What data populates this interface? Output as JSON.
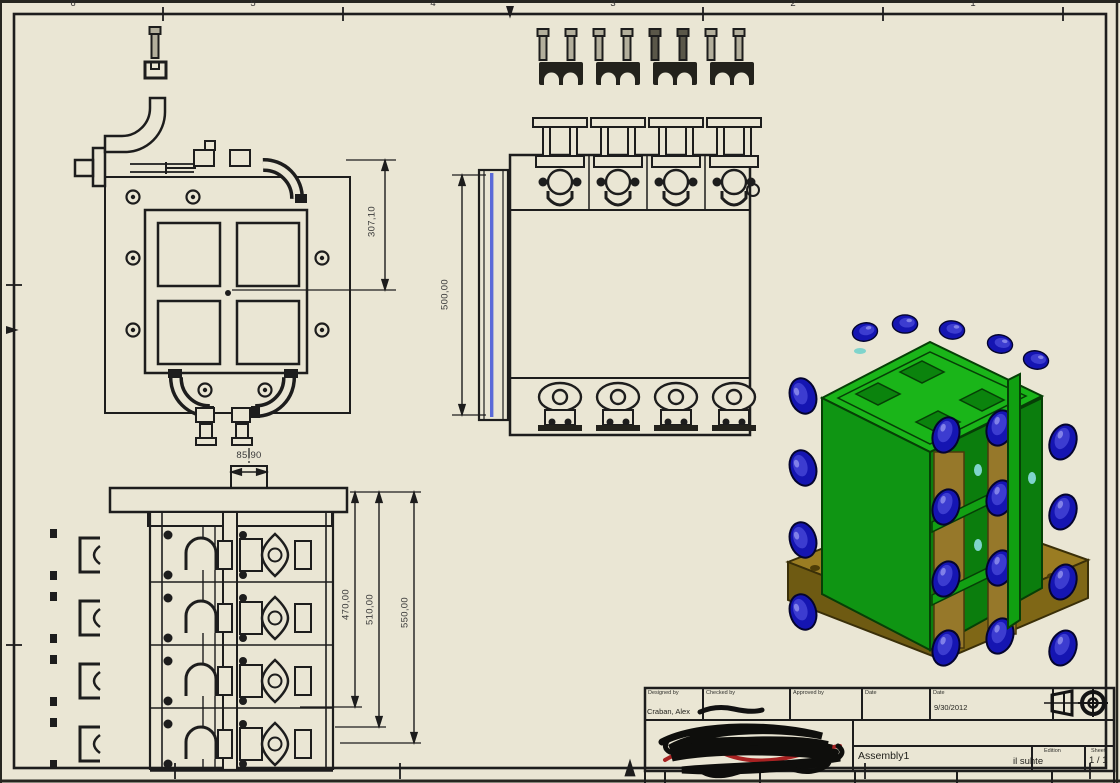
{
  "sheet": {
    "background_color": "#eae6d4",
    "line_color": "#1d1d1d",
    "highlight_color": "#5a6ad8"
  },
  "border": {
    "zone_numbers": [
      "6",
      "5",
      "4",
      "3",
      "2",
      "1"
    ]
  },
  "dimensions": {
    "plan_view_height": "307,10",
    "front_view_height": "500,00",
    "side_view_width": "85,90",
    "side_view_inner_height": "470,00",
    "side_view_mid_height": "510,00",
    "side_view_total_height": "550,00"
  },
  "title_block": {
    "designed_by_label": "Designed by",
    "designed_by_value": "Craban, Alex",
    "checked_by_label": "Checked by",
    "approved_by_label": "Approved by",
    "date_label": "Date",
    "date_label_2": "Date",
    "date_value": "9/30/2012",
    "part_name": "Assembly1",
    "edition_label": "Edition",
    "edition_value": "il suhte",
    "sheet_label": "Sheet",
    "sheet_value": "1 / 1"
  },
  "model": {
    "green": "#12a013",
    "green_dark": "#0b7d0d",
    "green_top": "#1ab519",
    "base_top": "#9a7c22",
    "base_front": "#6e5a12",
    "base_right": "#7f6716",
    "knob_blue": "#1515b2",
    "knob_highlight": "#4646d6",
    "hardware_tan": "#96782a",
    "glint_cyan": "#7fd4cc"
  }
}
